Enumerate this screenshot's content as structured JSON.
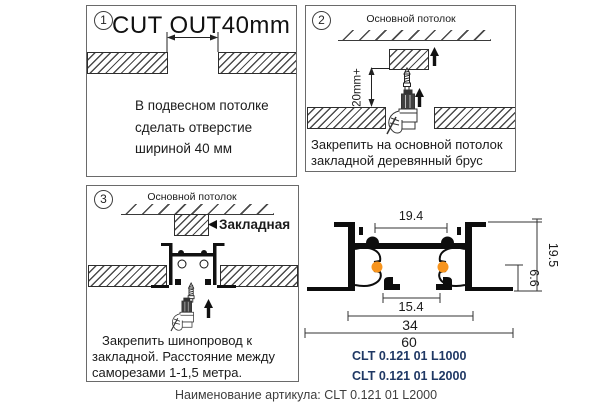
{
  "panel1": {
    "step": "1",
    "title_main": "CUT OUT",
    "title_dim": "40mm",
    "line1": "В подвесном потолке",
    "line2": "сделать отверстие",
    "line3": "шириной 40 мм"
  },
  "panel2": {
    "step": "2",
    "ceiling_label": "Основной потолок",
    "gap_dim": "20mm+",
    "line1": "Закрепить на основной потолок",
    "line2": "закладной деревянный брус"
  },
  "panel3": {
    "step": "3",
    "ceiling_label": "Основной потолок",
    "embed_label": "Закладная",
    "line1": "Закрепить шинопровод к",
    "line2": "закладной. Расстояние между",
    "line3": "саморезами 1-1,5 метра."
  },
  "profile": {
    "dim_top_inner": "19.4",
    "dim_height": "19.5",
    "dim_recess": "6.6",
    "dim_bottom_inner": "15.4",
    "dim_body_width": "34",
    "dim_overall_width": "60",
    "code1": "CLT 0.121 01 L1000",
    "code2": "CLT 0.121 01 L2000",
    "conductor_color": "#F7941D"
  },
  "footer": {
    "label": "Наименование артикула: CLT 0.121 01 L2000"
  }
}
